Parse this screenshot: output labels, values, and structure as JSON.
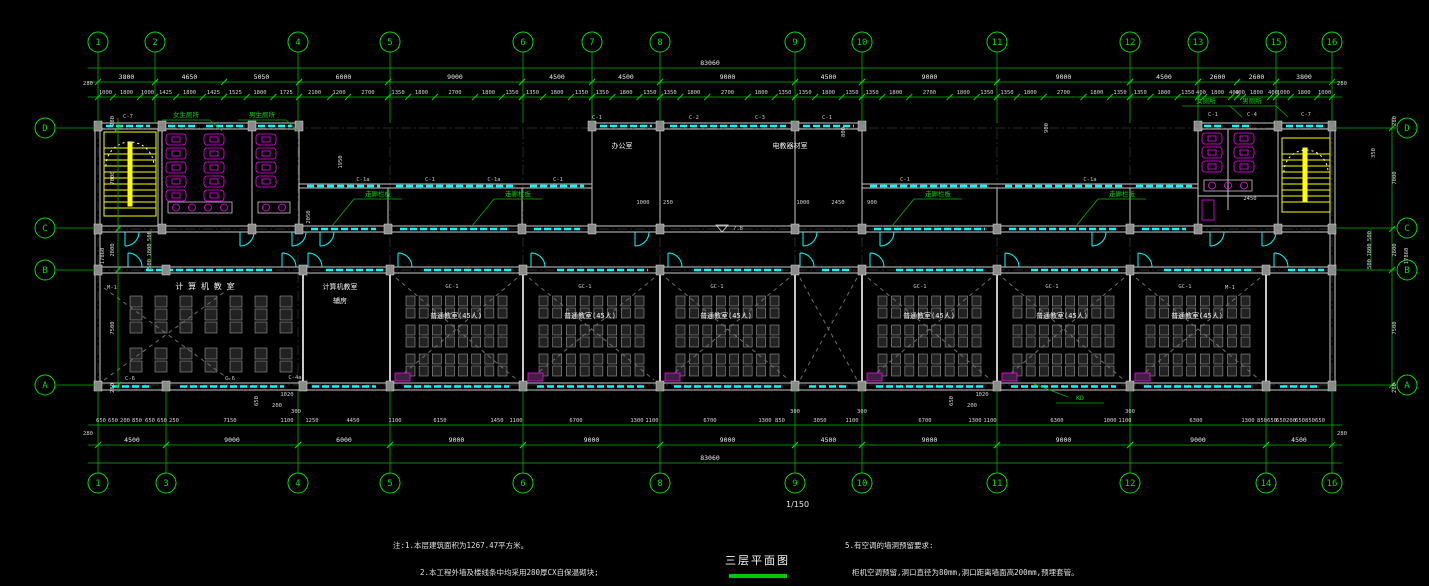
{
  "drawing": {
    "title": "三层平面图",
    "scale": "1/150",
    "overall_width": "83060",
    "overall_height": "17860"
  },
  "notes": {
    "left": [
      "注:1.本层建筑面积为1267.47平方米。",
      "2.本工程外墙及楼线条中均采用280厚CX自保温砌块;"
    ],
    "right": [
      "5.有空调的墙洞预留要求:",
      "柜机空调预留,洞口直径为80mm,洞口距离墙面高200mm,预埋套管。"
    ]
  },
  "colors": {
    "axis_green": "#00d800",
    "wall": "#c8c8c8",
    "window_cyan": "#00ffff",
    "fixture_magenta": "#ff00ff",
    "stair_yellow": "#ffff00"
  },
  "axes": {
    "top": [
      {
        "label": "1",
        "x": 98
      },
      {
        "label": "2",
        "x": 155
      },
      {
        "label": "4",
        "x": 298
      },
      {
        "label": "5",
        "x": 390
      },
      {
        "label": "6",
        "x": 523
      },
      {
        "label": "7",
        "x": 592
      },
      {
        "label": "8",
        "x": 660
      },
      {
        "label": "9",
        "x": 795
      },
      {
        "label": "10",
        "x": 862
      },
      {
        "label": "11",
        "x": 997
      },
      {
        "label": "12",
        "x": 1130
      },
      {
        "label": "13",
        "x": 1198
      },
      {
        "label": "15",
        "x": 1276
      },
      {
        "label": "16",
        "x": 1332
      }
    ],
    "bottom": [
      {
        "label": "1",
        "x": 98
      },
      {
        "label": "3",
        "x": 166
      },
      {
        "label": "4",
        "x": 298
      },
      {
        "label": "5",
        "x": 390
      },
      {
        "label": "6",
        "x": 523
      },
      {
        "label": "8",
        "x": 660
      },
      {
        "label": "9",
        "x": 795
      },
      {
        "label": "10",
        "x": 862
      },
      {
        "label": "11",
        "x": 997
      },
      {
        "label": "12",
        "x": 1130
      },
      {
        "label": "14",
        "x": 1266
      },
      {
        "label": "16",
        "x": 1332
      }
    ],
    "left": [
      {
        "label": "D",
        "y": 128
      },
      {
        "label": "C",
        "y": 228
      },
      {
        "label": "B",
        "y": 270
      },
      {
        "label": "A",
        "y": 385
      }
    ],
    "right": [
      {
        "label": "D",
        "y": 128
      },
      {
        "label": "C",
        "y": 228
      },
      {
        "label": "B",
        "y": 270
      },
      {
        "label": "A",
        "y": 385
      }
    ]
  },
  "dims": {
    "overall_top": {
      "t": "83060",
      "x": 710,
      "y": 65
    },
    "overall_bottom": {
      "t": "83060",
      "x": 710,
      "y": 460
    },
    "top_bays": [
      {
        "from": 98,
        "to": 155,
        "label": "3800",
        "dims": [
          1000,
          1800,
          1000
        ]
      },
      {
        "from": 155,
        "to": 224,
        "label": "4650",
        "dims": [
          1425,
          1800,
          1425
        ]
      },
      {
        "from": 224,
        "to": 299,
        "label": "5050",
        "dims": [
          1525,
          1800,
          1725
        ]
      },
      {
        "from": 299,
        "to": 388,
        "label": "6000",
        "dims": [
          2100,
          1200,
          2700
        ]
      },
      {
        "from": 388,
        "to": 522,
        "label": "9000",
        "dims": [
          1350,
          1800,
          2700,
          1800,
          1350
        ]
      },
      {
        "from": 522,
        "to": 592,
        "label": "4500",
        "dims": [
          1350,
          1800,
          1350
        ]
      },
      {
        "from": 592,
        "to": 660,
        "label": "4500",
        "dims": [
          1350,
          1800,
          1350
        ]
      },
      {
        "from": 660,
        "to": 795,
        "label": "9000",
        "dims": [
          1350,
          1800,
          2700,
          1800,
          1350
        ]
      },
      {
        "from": 795,
        "to": 862,
        "label": "4500",
        "dims": [
          1350,
          1800,
          1350
        ]
      },
      {
        "from": 862,
        "to": 997,
        "label": "9000",
        "dims": [
          1350,
          1800,
          2700,
          1800,
          1350
        ]
      },
      {
        "from": 997,
        "to": 1130,
        "label": "9000",
        "dims": [
          1350,
          1800,
          2700,
          1800,
          1350
        ]
      },
      {
        "from": 1130,
        "to": 1198,
        "label": "4500",
        "dims": [
          1350,
          1800,
          1350
        ]
      },
      {
        "from": 1198,
        "to": 1237,
        "label": "2600",
        "dims": [
          400,
          1800,
          400
        ]
      },
      {
        "from": 1237,
        "to": 1276,
        "label": "2600",
        "dims": [
          400,
          1800,
          400
        ]
      },
      {
        "from": 1276,
        "to": 1332,
        "label": "3800",
        "dims": [
          1000,
          1800,
          1000
        ]
      }
    ],
    "bottom_bays": [
      {
        "from": 98,
        "to": 166,
        "label": "4500"
      },
      {
        "from": 166,
        "to": 298,
        "label": "9000"
      },
      {
        "from": 298,
        "to": 390,
        "label": "6000"
      },
      {
        "from": 390,
        "to": 523,
        "label": "9000"
      },
      {
        "from": 523,
        "to": 660,
        "label": "9000"
      },
      {
        "from": 660,
        "to": 795,
        "label": "9000"
      },
      {
        "from": 795,
        "to": 862,
        "label": "4500"
      },
      {
        "from": 862,
        "to": 997,
        "label": "9000"
      },
      {
        "from": 997,
        "to": 1130,
        "label": "9000"
      },
      {
        "from": 1130,
        "to": 1266,
        "label": "9000"
      },
      {
        "from": 1266,
        "to": 1332,
        "label": "4500"
      }
    ],
    "bottom_fine": [
      [
        101,
        "650"
      ],
      [
        113,
        "650"
      ],
      [
        125,
        "200"
      ],
      [
        137,
        "850"
      ],
      [
        150,
        "650"
      ],
      [
        162,
        "650"
      ],
      [
        174,
        "250"
      ],
      [
        230,
        "7150"
      ],
      [
        287,
        "1100"
      ],
      [
        312,
        "1250"
      ],
      [
        353,
        "4450"
      ],
      [
        395,
        "1100"
      ],
      [
        440,
        "6150"
      ],
      [
        497,
        "1450"
      ],
      [
        516,
        "1100"
      ],
      [
        576,
        "6700"
      ],
      [
        637,
        "1300"
      ],
      [
        652,
        "1100"
      ],
      [
        710,
        "6700"
      ],
      [
        765,
        "1300"
      ],
      [
        780,
        "850"
      ],
      [
        820,
        "3050"
      ],
      [
        852,
        "1100"
      ],
      [
        925,
        "6700"
      ],
      [
        975,
        "1300"
      ],
      [
        990,
        "1100"
      ],
      [
        1057,
        "6300"
      ],
      [
        1110,
        "1000"
      ],
      [
        1125,
        "1100"
      ],
      [
        1196,
        "6300"
      ],
      [
        1248,
        "1300"
      ],
      [
        1262,
        "850"
      ],
      [
        1272,
        "650"
      ],
      [
        1281,
        "650"
      ],
      [
        1291,
        "200"
      ],
      [
        1300,
        "650"
      ],
      [
        1310,
        "850"
      ],
      [
        1320,
        "650"
      ]
    ],
    "left_side": [
      {
        "t": "280",
        "x": 114,
        "y": 121
      },
      {
        "t": "7000",
        "x": 114,
        "y": 178
      },
      {
        "t": "2800",
        "x": 114,
        "y": 250
      },
      {
        "t": "7500",
        "x": 114,
        "y": 328
      },
      {
        "t": "280",
        "x": 114,
        "y": 388
      },
      {
        "t": "17860",
        "x": 104,
        "y": 256
      },
      {
        "t": "500",
        "x": 151,
        "y": 236
      },
      {
        "t": "1800",
        "x": 151,
        "y": 250
      },
      {
        "t": "500",
        "x": 151,
        "y": 264
      }
    ],
    "right_side": [
      {
        "t": "280",
        "x": 1396,
        "y": 121
      },
      {
        "t": "7000",
        "x": 1396,
        "y": 178
      },
      {
        "t": "2800",
        "x": 1396,
        "y": 250
      },
      {
        "t": "7500",
        "x": 1396,
        "y": 328
      },
      {
        "t": "280",
        "x": 1396,
        "y": 388
      },
      {
        "t": "17860",
        "x": 1408,
        "y": 256
      },
      {
        "t": "500",
        "x": 1371,
        "y": 236
      },
      {
        "t": "1800",
        "x": 1371,
        "y": 250
      },
      {
        "t": "500",
        "x": 1371,
        "y": 264
      }
    ],
    "misc": [
      {
        "t": "7.8",
        "x": 738,
        "y": 230
      },
      {
        "t": "1000",
        "x": 643,
        "y": 204
      },
      {
        "t": "250",
        "x": 668,
        "y": 204
      },
      {
        "t": "1000",
        "x": 803,
        "y": 204
      },
      {
        "t": "2450",
        "x": 838,
        "y": 204
      },
      {
        "t": "900",
        "x": 872,
        "y": 204
      },
      {
        "t": "2450",
        "x": 1250,
        "y": 200
      },
      {
        "t": "1020",
        "x": 287,
        "y": 396
      },
      {
        "t": "200",
        "x": 277,
        "y": 407
      },
      {
        "t": "1020",
        "x": 982,
        "y": 396
      },
      {
        "t": "200",
        "x": 972,
        "y": 407
      },
      {
        "t": "300",
        "x": 296,
        "y": 413
      },
      {
        "t": "300",
        "x": 795,
        "y": 413
      },
      {
        "t": "300",
        "x": 862,
        "y": 413
      },
      {
        "t": "300",
        "x": 1130,
        "y": 413
      },
      {
        "t": "280",
        "x": 88,
        "y": 85
      },
      {
        "t": "280",
        "x": 1342,
        "y": 85
      },
      {
        "t": "280",
        "x": 88,
        "y": 435
      },
      {
        "t": "280",
        "x": 1342,
        "y": 435
      },
      {
        "t": "650",
        "x": 258,
        "y": 401,
        "r": 1
      },
      {
        "t": "650",
        "x": 953,
        "y": 401,
        "r": 1
      },
      {
        "t": "800",
        "x": 845,
        "y": 132,
        "r": 1
      },
      {
        "t": "2050",
        "x": 310,
        "y": 217,
        "r": 1
      },
      {
        "t": "1950",
        "x": 342,
        "y": 162,
        "r": 1
      },
      {
        "t": "350",
        "x": 1375,
        "y": 153,
        "r": 1
      },
      {
        "t": "900",
        "x": 1048,
        "y": 128,
        "r": 1
      }
    ]
  },
  "rooms": [
    {
      "label": "计 算 机 教 室",
      "x": 205,
      "y": 289,
      "cls": "room"
    },
    {
      "label": "计算机教室",
      "x": 340,
      "y": 289,
      "cls": "rooms"
    },
    {
      "label": "辅房",
      "x": 340,
      "y": 303,
      "cls": "rooms"
    },
    {
      "label": "办公室",
      "x": 622,
      "y": 148,
      "cls": "rooms"
    },
    {
      "label": "电教器材室",
      "x": 790,
      "y": 148,
      "cls": "rooms"
    },
    {
      "label": "普通教室(45人)",
      "x": 456,
      "y": 318,
      "cls": "rooms"
    },
    {
      "label": "普通教室(45人)",
      "x": 590,
      "y": 318,
      "cls": "rooms"
    },
    {
      "label": "普通教室(45人)",
      "x": 726,
      "y": 318,
      "cls": "rooms"
    },
    {
      "label": "普通教室(45人)",
      "x": 929,
      "y": 318,
      "cls": "rooms"
    },
    {
      "label": "普通教室(45人)",
      "x": 1062,
      "y": 318,
      "cls": "rooms"
    },
    {
      "label": "普通教室(45人)",
      "x": 1197,
      "y": 318,
      "cls": "rooms"
    }
  ],
  "green_labels": [
    {
      "label": "女生厕所",
      "x": 186,
      "y": 117,
      "lead": "dr"
    },
    {
      "label": "男生厕所",
      "x": 262,
      "y": 117,
      "lead": "dr"
    },
    {
      "label": "女厕所",
      "x": 1206,
      "y": 103,
      "lead": "dr"
    },
    {
      "label": "男厕所",
      "x": 1252,
      "y": 103,
      "lead": "dr"
    },
    {
      "label": "走廊栏板",
      "x": 378,
      "y": 196,
      "lead": "dl"
    },
    {
      "label": "走廊栏板",
      "x": 518,
      "y": 196,
      "lead": "dl"
    },
    {
      "label": "走廊栏板",
      "x": 938,
      "y": 196,
      "lead": "dl"
    },
    {
      "label": "走廊栏板",
      "x": 1122,
      "y": 196,
      "lead": "dl"
    },
    {
      "label": "KD",
      "x": 1080,
      "y": 400,
      "lead": "ul"
    }
  ],
  "tags": [
    [
      128,
      118,
      "C-7"
    ],
    [
      597,
      119,
      "C-1"
    ],
    [
      694,
      119,
      "C-2"
    ],
    [
      760,
      119,
      "C-3"
    ],
    [
      827,
      119,
      "C-1"
    ],
    [
      1213,
      116,
      "C-1"
    ],
    [
      1252,
      116,
      "C-4"
    ],
    [
      1306,
      116,
      "C-7"
    ],
    [
      363,
      181,
      "C-1a"
    ],
    [
      430,
      181,
      "C-1"
    ],
    [
      494,
      181,
      "C-1a"
    ],
    [
      558,
      181,
      "C-1"
    ],
    [
      905,
      181,
      "C-1"
    ],
    [
      1090,
      181,
      "C-1a"
    ],
    [
      452,
      288,
      "GC-1"
    ],
    [
      585,
      288,
      "GC-1"
    ],
    [
      717,
      288,
      "GC-1"
    ],
    [
      920,
      288,
      "GC-1"
    ],
    [
      1052,
      288,
      "GC-1"
    ],
    [
      1185,
      288,
      "GC-1"
    ],
    [
      130,
      380,
      "C-6"
    ],
    [
      230,
      380,
      "C-6"
    ],
    [
      295,
      379,
      "C-4a"
    ],
    [
      112,
      289,
      "M-1"
    ],
    [
      1230,
      289,
      "M-1"
    ]
  ]
}
